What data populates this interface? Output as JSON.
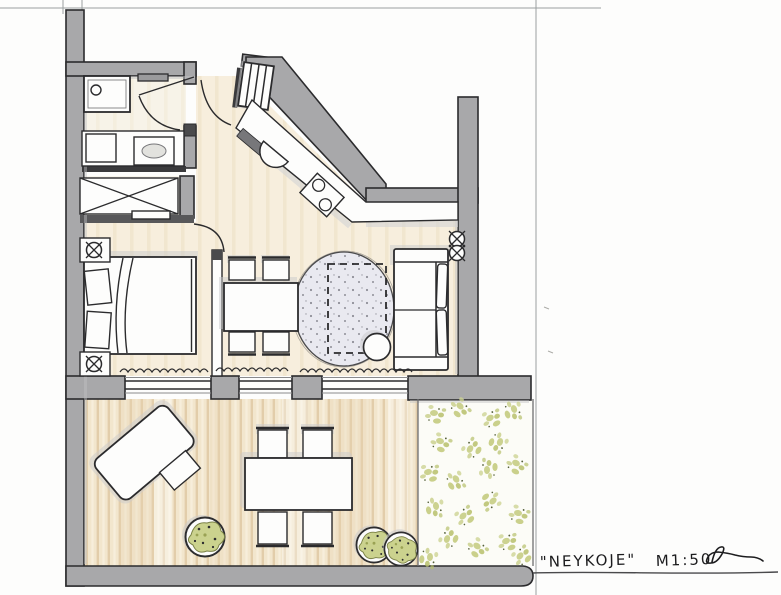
{
  "annotation": {
    "title": "\"NEYKOJE\"",
    "scale": "M1:50",
    "signature_icon": "handwritten-initials-flourish"
  },
  "colors": {
    "paper": "#fdfdfc",
    "wall_gray": "#a8a8aa",
    "ink": "#2b2b2d",
    "interior_floor": "#f7eedd",
    "bath_floor": "#f7f3e8",
    "deck": "#f2e6cd",
    "deck_plank_line": "#dcc49e",
    "garden_speckle": "#c6cd84",
    "rug": "#e9e9f0",
    "shadow": "#c9c9cb",
    "pencil_line": "#9aa0a0"
  },
  "elements": {
    "rooms": [
      "bathroom",
      "entry",
      "kitchen",
      "sleeping-living-room",
      "terrace",
      "garden"
    ],
    "furniture": [
      "shower",
      "toilet",
      "vanity-sink",
      "wardrobe",
      "bed",
      "nightstands",
      "dining-table",
      "dining-chairs",
      "kitchen-counter",
      "kitchen-sink",
      "cooktop",
      "sofa",
      "round-rug",
      "berth-outline",
      "side-table",
      "sun-lounger",
      "outdoor-table",
      "outdoor-chairs",
      "potted-plants"
    ],
    "symbols": [
      "lamp-cross-circle",
      "power-outlet-cross-circle",
      "curtain-squiggle",
      "door-swing-arcs",
      "entry-steps"
    ]
  }
}
